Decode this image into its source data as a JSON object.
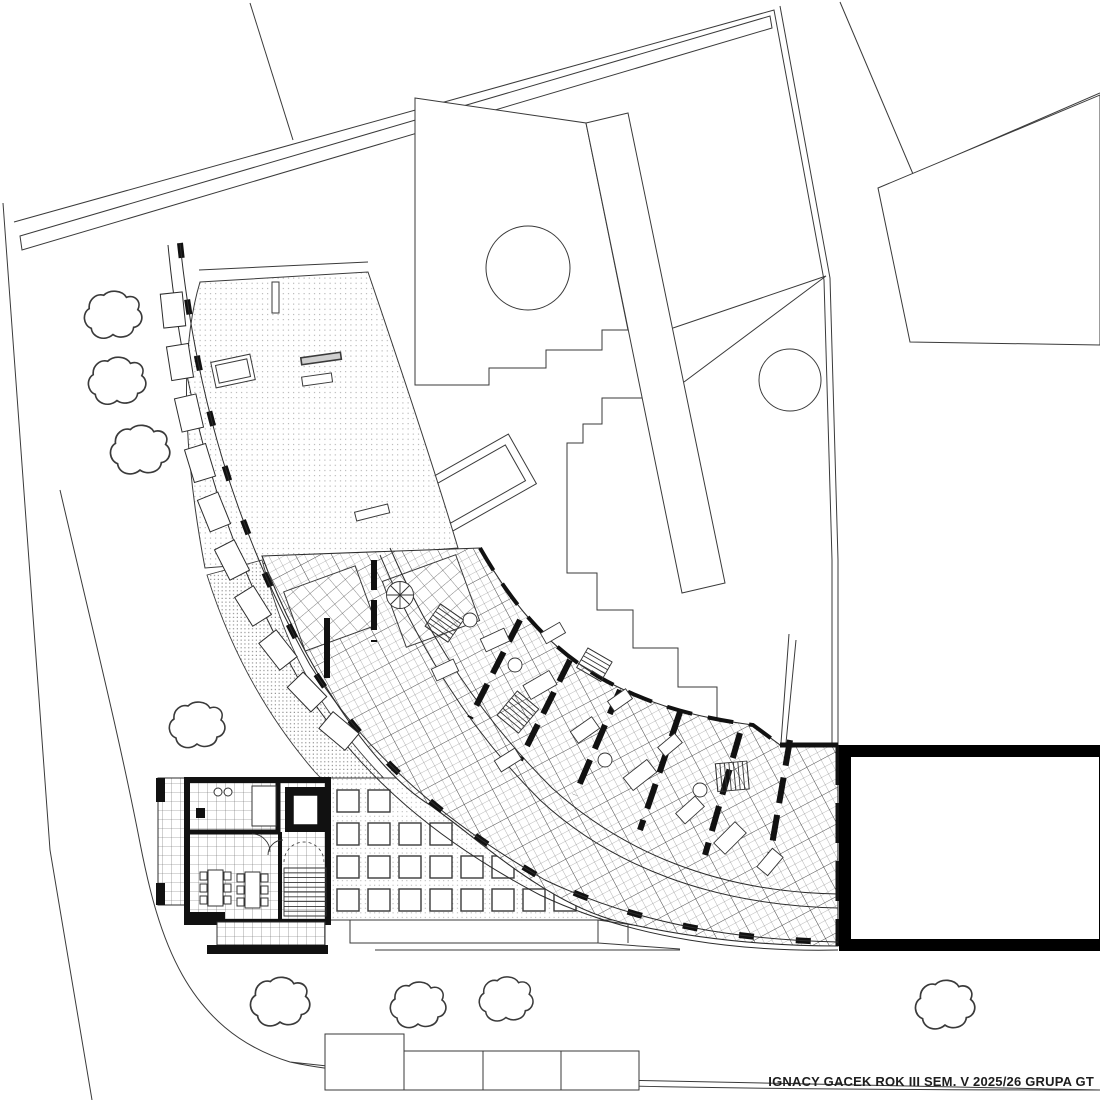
{
  "title_block": {
    "text": "IGNACY GACEK ROK III SEM. V 2025/26 GRUPA GT"
  },
  "drawing": {
    "kind": "architectural site plan with curved apartment building floor plan",
    "paper_color": "#ffffff",
    "ink_color": "#1d1d1d",
    "hatch_color": "#8a8a8a"
  }
}
